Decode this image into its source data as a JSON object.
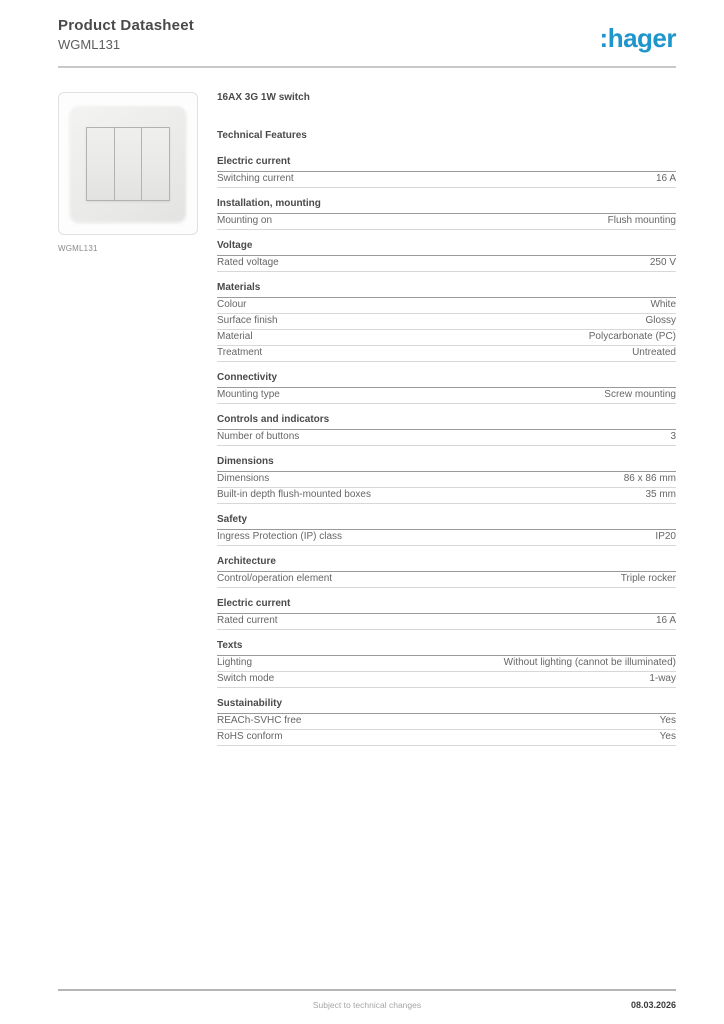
{
  "header": {
    "title": "Product Datasheet",
    "subtitle": "WGML131",
    "brand": ":hager",
    "brand_color": "#1e96cc"
  },
  "product": {
    "name": "16AX 3G 1W switch",
    "image_caption": "WGML131",
    "image_description": "white triple-rocker wall switch"
  },
  "table": {
    "heading": "Technical Features",
    "sections": [
      {
        "title": "Electric current",
        "rows": [
          {
            "label": "Switching current",
            "value": "16 A"
          }
        ]
      },
      {
        "title": "Installation, mounting",
        "rows": [
          {
            "label": "Mounting on",
            "value": "Flush mounting"
          }
        ]
      },
      {
        "title": "Voltage",
        "rows": [
          {
            "label": "Rated voltage",
            "value": "250 V"
          }
        ]
      },
      {
        "title": "Materials",
        "rows": [
          {
            "label": "Colour",
            "value": "White"
          },
          {
            "label": "Surface finish",
            "value": "Glossy"
          },
          {
            "label": "Material",
            "value": "Polycarbonate (PC)"
          },
          {
            "label": "Treatment",
            "value": "Untreated"
          }
        ]
      },
      {
        "title": "Connectivity",
        "rows": [
          {
            "label": "Mounting type",
            "value": "Screw mounting"
          }
        ]
      },
      {
        "title": "Controls and indicators",
        "rows": [
          {
            "label": "Number of buttons",
            "value": "3"
          }
        ]
      },
      {
        "title": "Dimensions",
        "rows": [
          {
            "label": "Dimensions",
            "value": "86 x 86 mm"
          },
          {
            "label": "Built-in depth flush-mounted boxes",
            "value": "35 mm"
          }
        ]
      },
      {
        "title": "Safety",
        "rows": [
          {
            "label": "Ingress Protection (IP) class",
            "value": "IP20"
          }
        ]
      },
      {
        "title": "Architecture",
        "rows": [
          {
            "label": "Control/operation element",
            "value": "Triple rocker"
          }
        ]
      },
      {
        "title": "Electric current",
        "rows": [
          {
            "label": "Rated current",
            "value": "16 A"
          }
        ]
      },
      {
        "title": "Texts",
        "rows": [
          {
            "label": "Lighting",
            "value": "Without lighting (cannot be illuminated)"
          },
          {
            "label": "Switch mode",
            "value": "1-way"
          }
        ]
      },
      {
        "title": "Sustainability",
        "rows": [
          {
            "label": "REACh-SVHC free",
            "value": "Yes"
          },
          {
            "label": "RoHS conform",
            "value": "Yes"
          }
        ]
      }
    ]
  },
  "footer": {
    "note": "Subject to technical changes",
    "date": "08.03.2026"
  }
}
